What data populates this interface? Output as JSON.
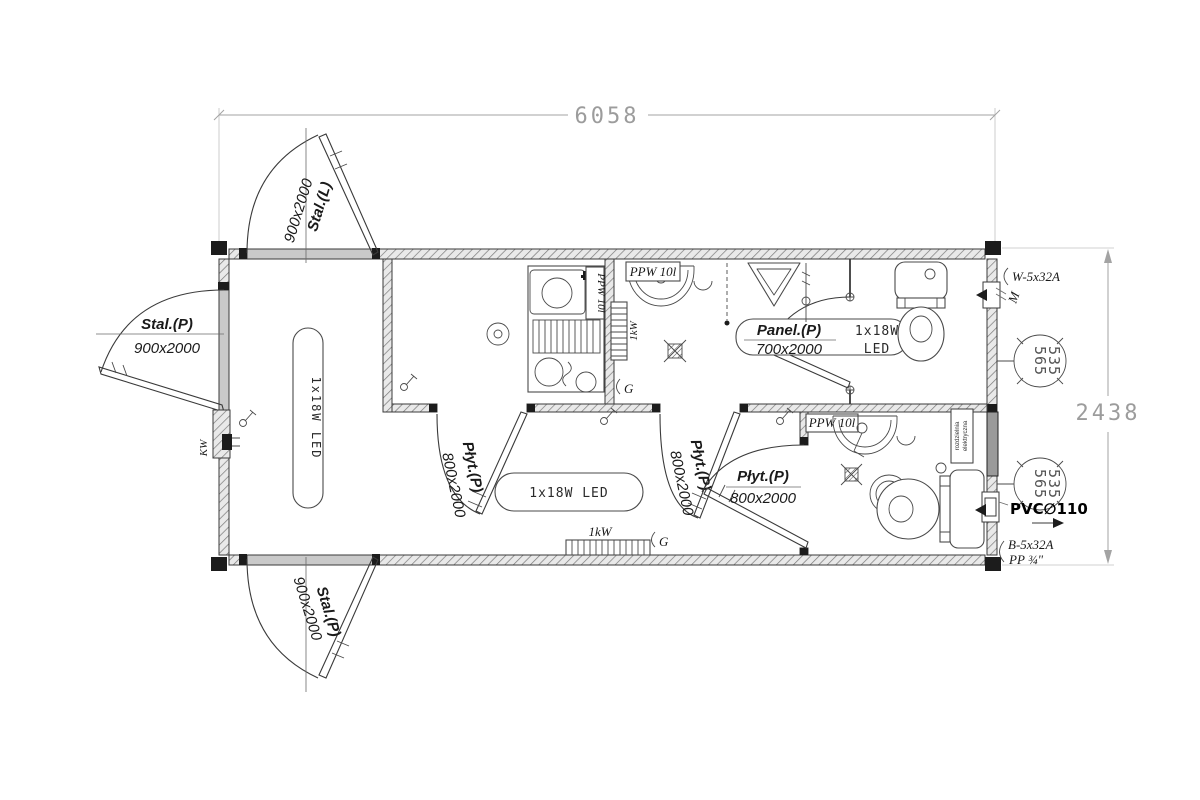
{
  "dims": {
    "width": "6058",
    "height": "2438"
  },
  "doors": {
    "entrance": {
      "type": "Stal.(P)",
      "size": "900x2000"
    },
    "top": {
      "type": "Stal.(L)",
      "size": "900x2000"
    },
    "bottom": {
      "type": "Stal.(P)",
      "size": "900x2000"
    },
    "kitchen": {
      "type": "Płyt.(P)",
      "size": "800x2000"
    },
    "washroom": {
      "type": "Płyt.(P)",
      "size": "800x2000"
    },
    "bathroom": {
      "type": "Płyt.(P)",
      "size": "800x2000"
    },
    "wc": {
      "type": "Panel.(P)",
      "size": "700x2000"
    }
  },
  "lamps": {
    "hall": "1x18W LED",
    "corridor": "1x18W LED",
    "wc_watt": "1x18W",
    "wc_type": "LED"
  },
  "heaters": {
    "kitchen": "PPW 10l",
    "washroom": "PPW 10l",
    "bathroom": "PPW 10l"
  },
  "radiators": {
    "washroom": "1kW",
    "corridor": "1kW"
  },
  "sockets": {
    "washroom": "G",
    "corridor": "G"
  },
  "electrical": {
    "feed_top": "W-5x32A",
    "feed_bottom": "B-5x32A",
    "meter": "M",
    "cable_entry": "KW",
    "panel_line1": "rozdzielnia",
    "panel_line2": "elektryczna"
  },
  "plumbing": {
    "pvc_outlet": "PVC∅110",
    "pp_supply": "PP ¾\""
  },
  "vents": {
    "top_line1": "565",
    "top_line2": "535",
    "bottom_line1": "565",
    "bottom_line2": "535"
  }
}
